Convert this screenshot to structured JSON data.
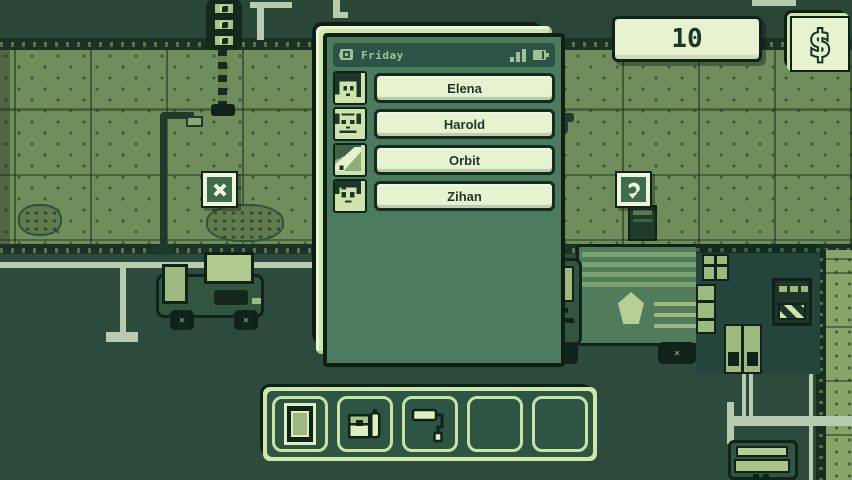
{
  "palette": {
    "road": "#2c4b3c",
    "sidewalk": "#6f8e5b",
    "panel_frame_light": "#cde8a9",
    "panel_fill": "#e7f3d0",
    "screen_green": "#4b7a5e",
    "outline_dark": "#0f1f16",
    "text_dark": "#1d3629",
    "text_light": "#9fc194"
  },
  "hud": {
    "money_value": "10",
    "currency_symbol": "$"
  },
  "phone": {
    "status_bar": {
      "day_label": "Friday",
      "icons": [
        "chat-icon",
        "signal-bars-icon",
        "battery-icon"
      ]
    },
    "contacts": [
      {
        "name": "Elena",
        "avatar_icon": "elena-portrait"
      },
      {
        "name": "Harold",
        "avatar_icon": "harold-portrait"
      },
      {
        "name": "Orbit",
        "avatar_icon": "orbit-portrait"
      },
      {
        "name": "Zihan",
        "avatar_icon": "zihan-portrait"
      }
    ]
  },
  "toolbar": {
    "slots": [
      {
        "icon": "tablet-icon",
        "empty": false
      },
      {
        "icon": "satchel-icon",
        "empty": false
      },
      {
        "icon": "paint-roller-icon",
        "empty": false
      },
      {
        "icon": "",
        "empty": true
      },
      {
        "icon": "",
        "empty": true
      }
    ]
  },
  "world_markers": [
    {
      "icon": "x-marker-icon"
    },
    {
      "icon": "grab-marker-icon"
    }
  ],
  "wheel_glyph": "✕"
}
